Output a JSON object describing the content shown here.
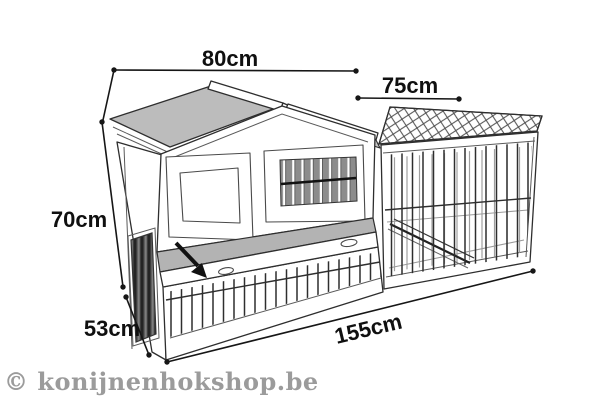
{
  "diagram": {
    "type": "product-dimension-drawing",
    "subject": "rabbit hutch with attached wire run, isometric line drawing"
  },
  "dimensions": {
    "roof_width": {
      "label": "80cm"
    },
    "run_width": {
      "label": "75cm"
    },
    "height": {
      "label": "70cm"
    },
    "depth": {
      "label": "53cm"
    },
    "total_length": {
      "label": "155cm"
    }
  },
  "watermark": {
    "text": "© konijnenhokshop.be"
  },
  "icons": {
    "lid_open_arrow": "arrow-pointing-down-right"
  },
  "colors": {
    "background": "#ffffff",
    "line_art": "#2e2e2e",
    "roof_gray": "#bcbcbc",
    "lid_gray": "#b3b3b3",
    "window_slats": "#8c8c8c",
    "dimension_text": "#101010",
    "watermark_gray": "#9b9b9b"
  }
}
